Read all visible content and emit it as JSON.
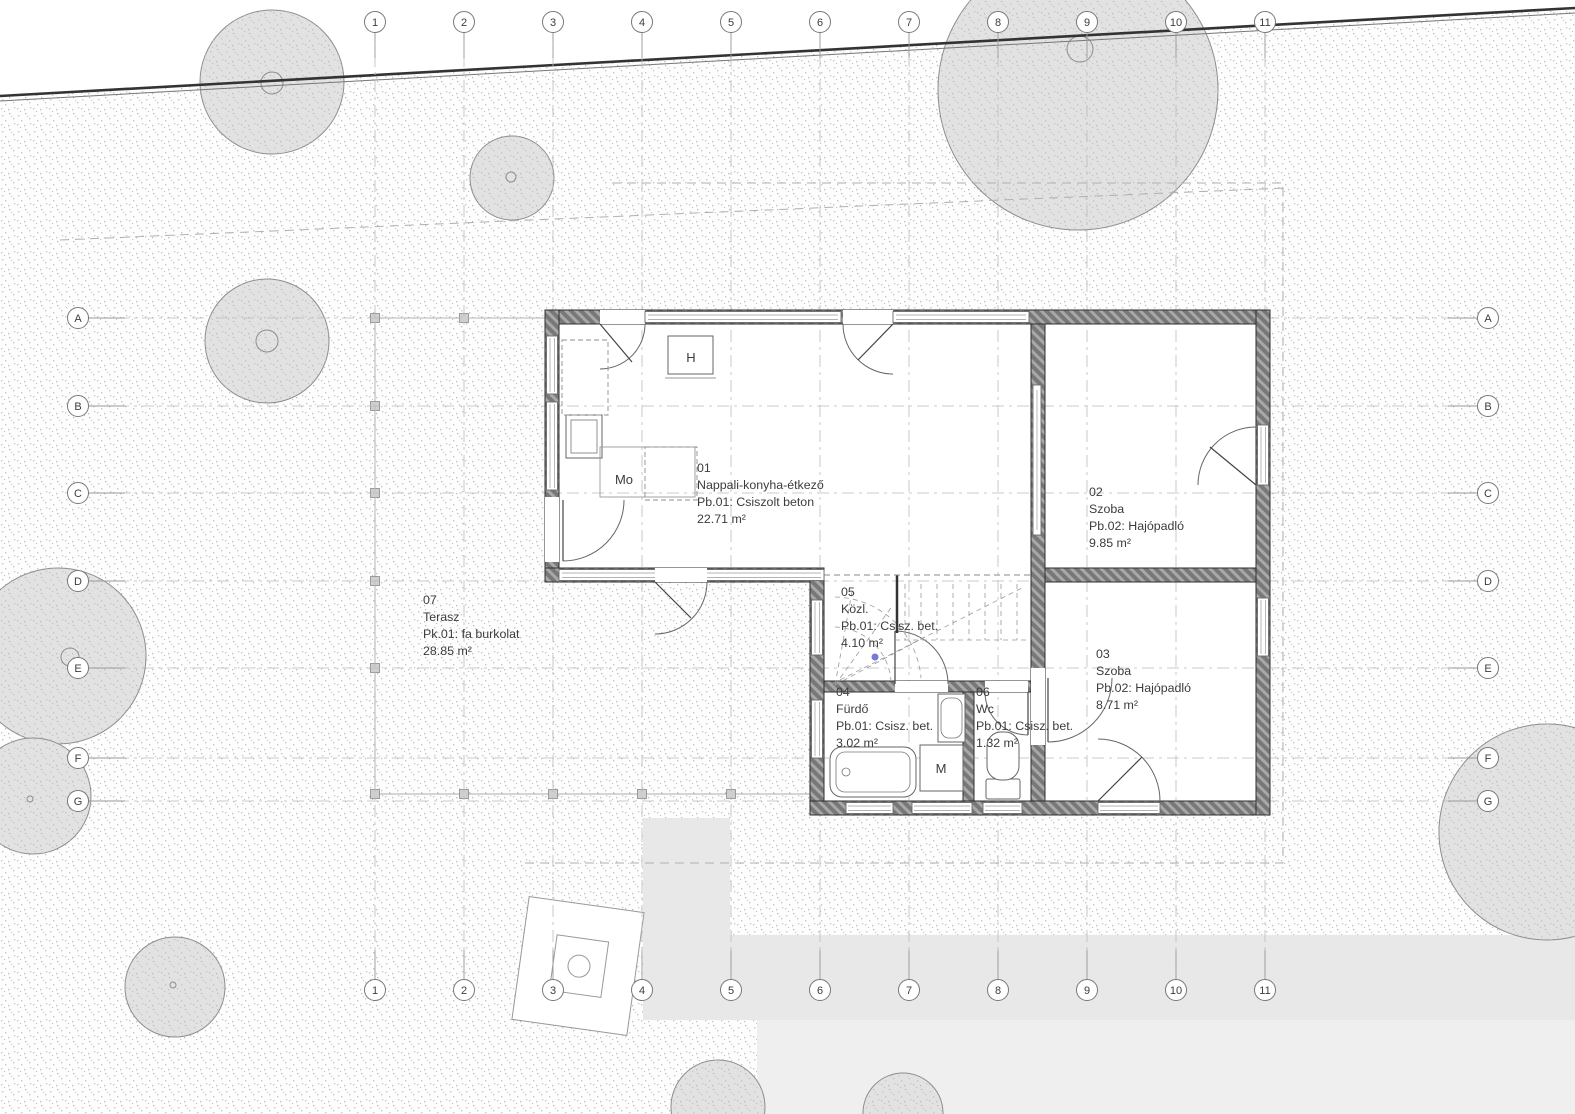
{
  "grid": {
    "columns": [
      "1",
      "2",
      "3",
      "4",
      "5",
      "6",
      "7",
      "8",
      "9",
      "10",
      "11"
    ],
    "rows": [
      "A",
      "B",
      "C",
      "D",
      "E",
      "F",
      "G"
    ]
  },
  "rooms": [
    {
      "id": "01",
      "name": "Nappali-konyha-étkező",
      "finish": "Pb.01: Csiszolt beton",
      "area": "22.71 m²"
    },
    {
      "id": "02",
      "name": "Szoba",
      "finish": "Pb.02: Hajópadló",
      "area": "9.85 m²"
    },
    {
      "id": "03",
      "name": "Szoba",
      "finish": "Pb.02: Hajópadló",
      "area": "8.71 m²"
    },
    {
      "id": "04",
      "name": "Fürdő",
      "finish": "Pb.01: Csisz. bet.",
      "area": "3.02 m²"
    },
    {
      "id": "05",
      "name": "Közl.",
      "finish": "Pb.01: Csisz. bet.",
      "area": "4.10 m²"
    },
    {
      "id": "06",
      "name": "Wc",
      "finish": "Pb.01: Csisz. bet.",
      "area": "1.32 m²"
    },
    {
      "id": "07",
      "name": "Terasz",
      "finish": "Pk.01: fa burkolat",
      "area": "28.85 m²"
    }
  ],
  "fixtures": {
    "fridge": "H",
    "sink": "Mo",
    "washing_machine": "M"
  },
  "colors": {
    "wall": "#787878",
    "text": "#3c3c3c",
    "tree_fill": "#e2e2e2",
    "path_fill": "#e8e8e8",
    "paved_fill": "#efefef",
    "stair_marker_blue": "#7878d8",
    "boundary": "#333333",
    "stipple_dot": "#c7c7c7"
  }
}
